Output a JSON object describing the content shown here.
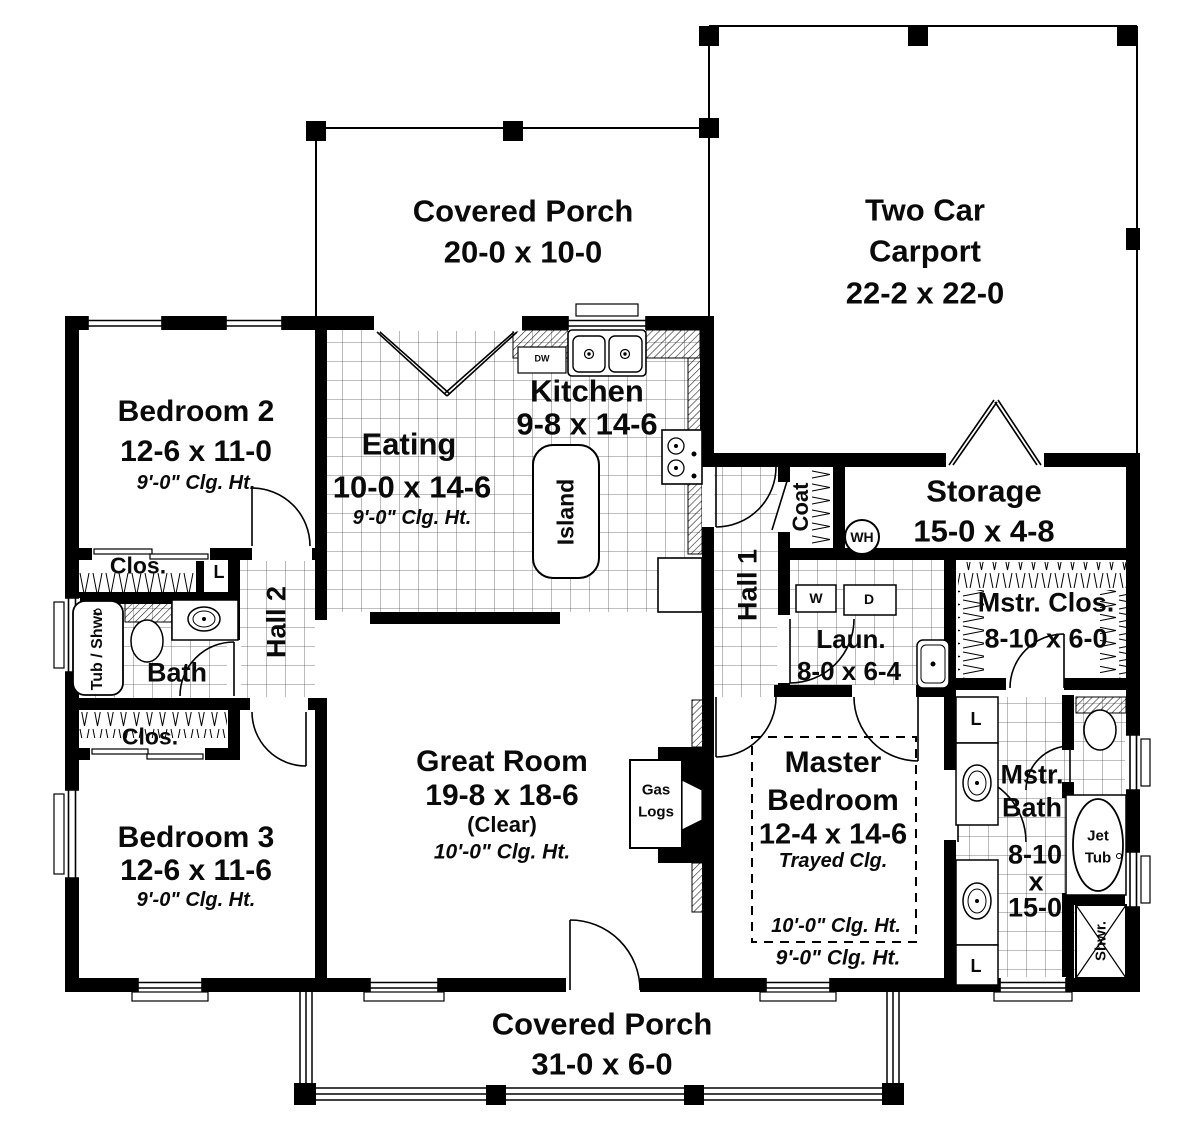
{
  "colors": {
    "walls": "#000000",
    "background": "#ffffff",
    "text": "#0a0a0a"
  },
  "rooms": {
    "porch_top": {
      "name": "Covered Porch",
      "dims": "20-0 x 10-0"
    },
    "carport": {
      "line1": "Two Car",
      "line2": "Carport",
      "dims": "22-2 x 22-0"
    },
    "bedroom2": {
      "name": "Bedroom 2",
      "dims": "12-6 x 11-0",
      "clg": "9'-0\" Clg. Ht."
    },
    "eating": {
      "name": "Eating",
      "dims": "10-0 x 14-6",
      "clg": "9'-0\" Clg. Ht."
    },
    "kitchen": {
      "name": "Kitchen",
      "dims": "9-8 x 14-6",
      "dw": "DW"
    },
    "island": {
      "name": "Island"
    },
    "hall1": {
      "name": "Hall 1"
    },
    "hall2": {
      "name": "Hall 2"
    },
    "coat": {
      "name": "Coat"
    },
    "water_heater": {
      "label": "WH"
    },
    "storage": {
      "name": "Storage",
      "dims": "15-0 x 4-8"
    },
    "laundry": {
      "name": "Laun.",
      "dims": "8-0 x 6-4",
      "washer": "W",
      "dryer": "D"
    },
    "mstr_clos": {
      "name": "Mstr. Clos.",
      "dims": "8-10 x 6-0"
    },
    "clos_bed2": {
      "name": "Clos."
    },
    "clos_bed3": {
      "name": "Clos."
    },
    "linen_hall2": {
      "label": "L"
    },
    "bath": {
      "name": "Bath",
      "tub": "Tub / Shwr"
    },
    "bedroom3": {
      "name": "Bedroom 3",
      "dims": "12-6 x 11-6",
      "clg": "9'-0\" Clg. Ht."
    },
    "great_room": {
      "name": "Great Room",
      "dims": "19-8 x 18-6",
      "clear": "(Clear)",
      "clg": "10'-0\" Clg. Ht."
    },
    "fireplace": {
      "line1": "Gas",
      "line2": "Logs"
    },
    "master_bedroom": {
      "line1": "Master",
      "line2": "Bedroom",
      "dims": "12-4 x 14-6",
      "tray": "Trayed Clg.",
      "clg_inner": "10'-0\" Clg. Ht.",
      "clg_outer": "9'-0\" Clg. Ht."
    },
    "mstr_bath": {
      "line1": "Mstr.",
      "line2": "Bath",
      "dim1": "8-10",
      "dim2": "x",
      "dim3": "15-0",
      "linen_top": "L",
      "linen_bottom": "L"
    },
    "jet_tub": {
      "line1": "Jet",
      "line2": "Tub"
    },
    "shower": {
      "name": "Shwr."
    },
    "porch_bottom": {
      "name": "Covered Porch",
      "dims": "31-0 x 6-0"
    }
  }
}
